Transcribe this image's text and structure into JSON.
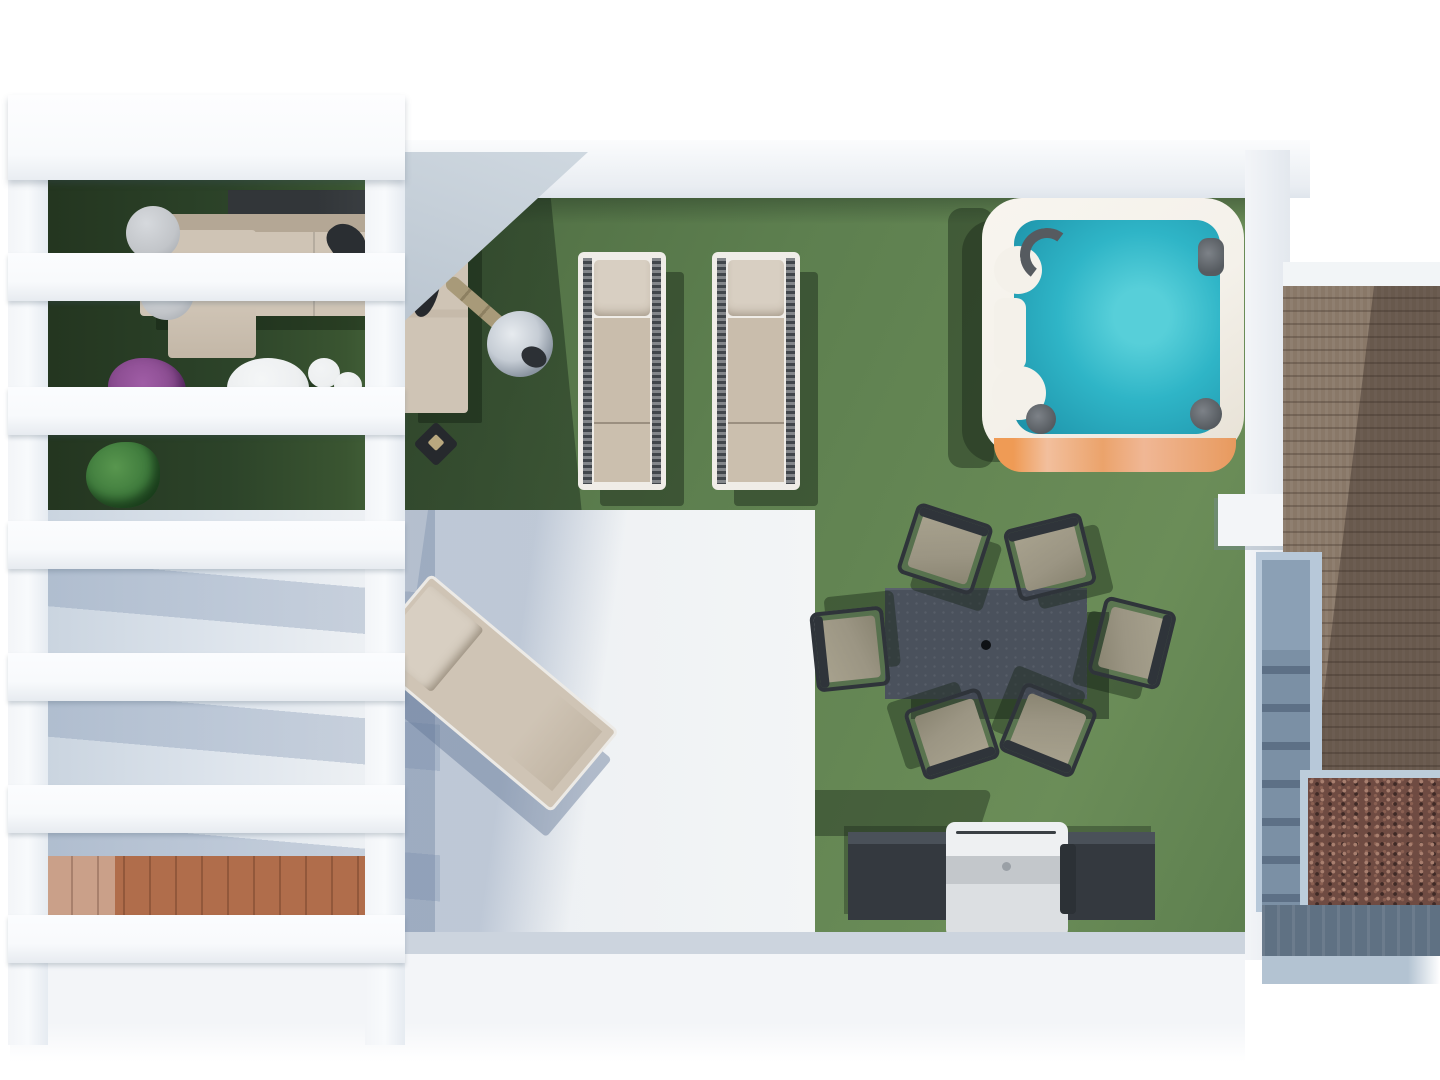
{
  "scene": {
    "title": "Rooftop terrace - top-down 3D architectural render",
    "view": "plan view from above",
    "rooms": [
      "pergola lounge corner",
      "artificial lawn",
      "white tiled patio",
      "hot tub corner",
      "dining lawn",
      "bbq corner",
      "timber deck with stairwell"
    ]
  },
  "colors": {
    "sky": "#ffffff",
    "wall": "#f3f5f8",
    "wall_shade": "#e3e8ee",
    "wall_edge": "#ccd4de",
    "pergola": "#f8fafc",
    "pergola_edge": "#e6ebf1",
    "grass": "#5d7f4f",
    "grass_light": "#6b8d58",
    "grass_dark": "#2c4329",
    "tile": "#edf0f3",
    "terracotta": "#b06d4b",
    "terracotta_light": "#caa089",
    "water": "#2fb5c7",
    "water_light": "#57cfd9",
    "water_deep": "#1b8ea6",
    "tub_rim": "#f4f1ea",
    "tub_base": "#ef9b55",
    "tub_base_light": "#f2bf9d",
    "tub_metal": "#565b60",
    "deck": "#897868",
    "gravel": "#6f4b42",
    "gravel_light": "#a87f6f",
    "stair_frame": "#b7c8d9",
    "stair_step": "#7b90a5",
    "stair_riser": "#5d7086",
    "stair_face": "#5f7183",
    "stair_land": "#b3c3d2",
    "sofa": "#cfc4b5",
    "sofa_dark": "#b4a795",
    "sofa_back": "#42464a",
    "lounger": "#c9bdac",
    "lounger_pillow": "#d8cfc2",
    "lounger_rail": "#41464b",
    "table": "#4a515c",
    "table_hole": "#0e1114",
    "chair_frame": "#2f343a",
    "chair_fabric": "#9b9583",
    "bbq": "#34393f",
    "bbq_top": "#4a5159",
    "grill": "#dcdfe2",
    "grill_mid": "#c3c7cb",
    "grill_dark": "#2c3136",
    "parasol_pole": "#a89a79",
    "parasol_dark": "#26292d",
    "chrome": "#c6cdd5",
    "chrome_dark": "#2c3035",
    "plant_purple": "#8a4c90",
    "plant_purple_dark": "#6e3678",
    "plant_green": "#3e7a3c",
    "plant_green_dark": "#2c5c2e",
    "white_table": "#edeff0",
    "stool_gray": "#c2c5c9"
  },
  "objects": {
    "pergola": {
      "label": "White slatted pergola",
      "slat_count": 6
    },
    "lawn": {
      "label": "Artificial grass lawn"
    },
    "patio": {
      "label": "White tiled patio"
    },
    "lounge_sofa": {
      "label": "L-shaped outdoor sofa with chaise"
    },
    "coffee_table": {
      "label": "Round white coffee table"
    },
    "side_stools": {
      "label": "White side stools",
      "count": 3
    },
    "side_cylinders": {
      "label": "Grey cylinder side tables",
      "count": 2
    },
    "plant_purple": {
      "label": "Purple flowering planter"
    },
    "plant_green": {
      "label": "Green foliage planter"
    },
    "lantern": {
      "label": "Garden lantern"
    },
    "parasol": {
      "label": "Folded parasol with chrome base"
    },
    "sun_loungers": {
      "label": "Sun loungers on lawn",
      "count": 2
    },
    "patio_lounger": {
      "label": "Angled sun lounger on patio",
      "count": 1
    },
    "hot_tub": {
      "label": "Square hot tub with turquoise water"
    },
    "dining_table": {
      "label": "Rectangular dining table with parasol hole"
    },
    "dining_chairs": {
      "label": "Dining chairs",
      "count": 6
    },
    "bbq_station": {
      "label": "BBQ counter with stainless grill"
    },
    "wood_deck": {
      "label": "Timber deck walkway"
    },
    "gravel_bed": {
      "label": "Decorative gravel bed"
    },
    "staircase": {
      "label": "Stairwell to lower level"
    },
    "walls": {
      "label": "White parapet walls"
    },
    "terracotta_wall": {
      "label": "Terracotta lower wall seen through pergola"
    }
  }
}
